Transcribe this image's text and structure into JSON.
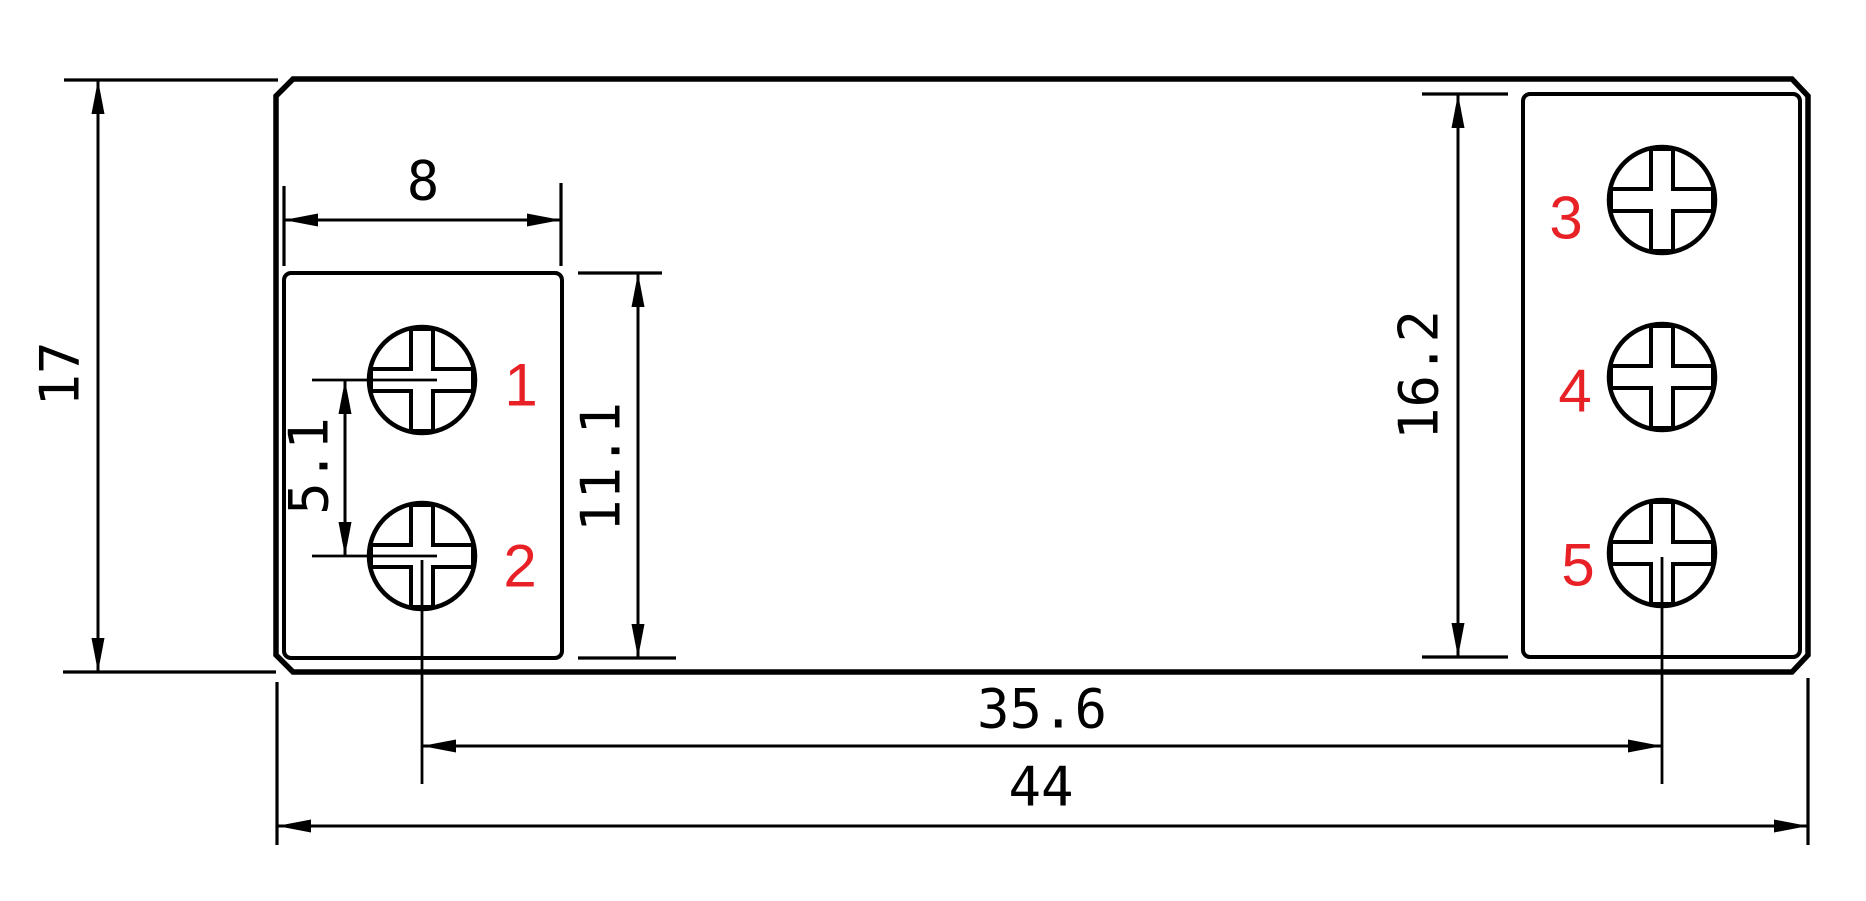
{
  "drawing": {
    "kind": "technical-dimension-drawing",
    "units_hint": "mm",
    "colors": {
      "line": "#000000",
      "dimension_text": "#000000",
      "terminal_number": "#e82127",
      "background": "#ffffff"
    },
    "dimensions": {
      "overall_height": "17",
      "overall_width": "44",
      "block_width": "8",
      "screw_pitch": "5.1",
      "left_block_height": "11.1",
      "right_block_height": "16.2",
      "screw_center_span": "35.6"
    },
    "terminals": [
      {
        "label": "1"
      },
      {
        "label": "2"
      },
      {
        "label": "3"
      },
      {
        "label": "4"
      },
      {
        "label": "5"
      }
    ]
  }
}
